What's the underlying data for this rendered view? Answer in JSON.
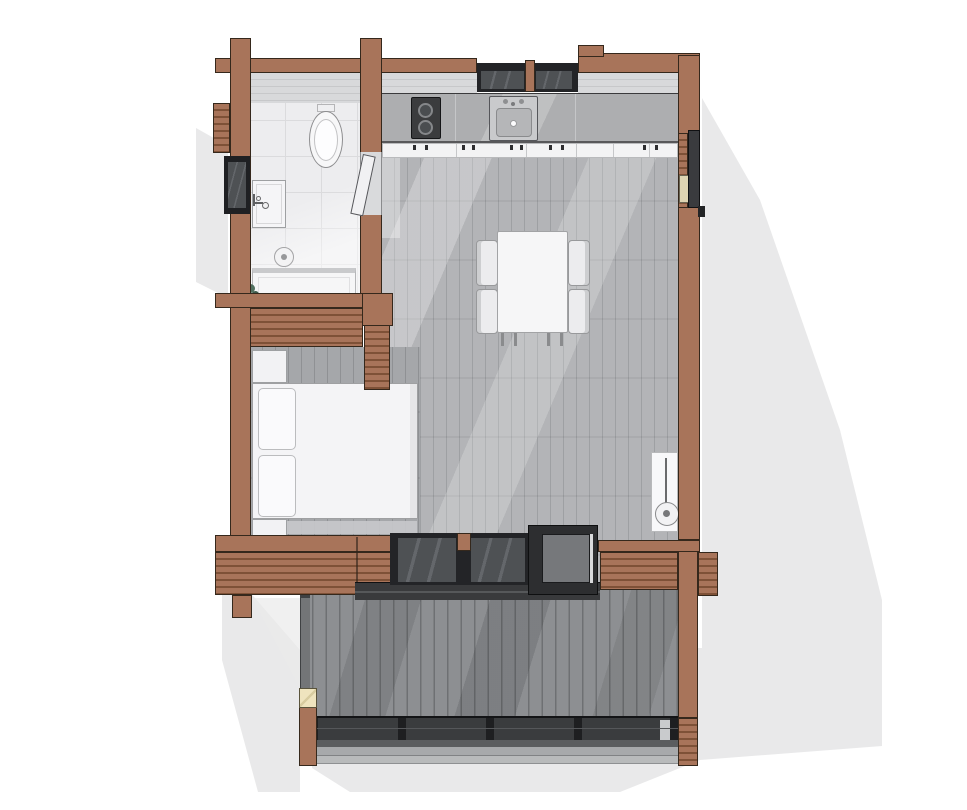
{
  "page": {
    "type": "floor-plan-rendering",
    "description": "Top-down 3D floor plan of a small log cabin: bathroom, kitchen with cooktop and sink, dining table with four chairs, sleeping alcove with double bed, floor lamp, entry doors and a large wooden deck with railing and steps"
  },
  "palette": {
    "bg": "#ffffff",
    "shadow": "#e9e9ea",
    "wall": "#a8745a",
    "wall_stripe": "#7e5137",
    "wall_outline": "#35281c",
    "wallface": "#d8d9db",
    "wallface_line": "#c7c8ca",
    "frame": "#232427",
    "glazing": "#4e5154",
    "glazing_hi": "#646growth"
  },
  "palette_fix": "see palette2",
  "palette2": {
    "glazing_hi": "#64676b",
    "floor_living": "#b3b4b7",
    "floor_living_gap": "#9ea0a3",
    "floor_bedroom": "#a5a7aa",
    "floor_bedroom_gap": "#8f9194",
    "floor_bath": "#ededef",
    "tile_line": "#dbdbdd",
    "counter": "#adaeb0",
    "cabinet": "#f3f3f4",
    "white_fixture": "#f5f5f7",
    "fixture_line": "#9ea0a2",
    "deck": "#8d8f92",
    "deck_gap": "#6e7073",
    "railing": "#3a3c3e",
    "railing_dark": "#1e1f21",
    "step_mid": "#a7a9ab",
    "step_light": "#b8babb",
    "platform": "#2d2e30",
    "platform_inner": "#76787b",
    "cream": "#efe4be",
    "plant": "#51705f",
    "threshold_dark": "#393a3c",
    "cooktop": "#3b3c3e",
    "sink_gray": "#c9cacc"
  },
  "rooms": [
    {
      "name": "bathroom",
      "fixtures": [
        "toilet",
        "wash-basin",
        "shower-drain",
        "shower-bench",
        "plant"
      ]
    },
    {
      "name": "kitchen",
      "fixtures": [
        "two-burner-cooktop",
        "kitchen-sink",
        "counter",
        "base-cabinets"
      ]
    },
    {
      "name": "living-dining",
      "fixtures": [
        "dining-table",
        "dining-chair",
        "dining-chair",
        "dining-chair",
        "dining-chair",
        "floor-lamp"
      ]
    },
    {
      "name": "sleeping-alcove",
      "fixtures": [
        "double-bed",
        "pillow",
        "pillow",
        "nightstand",
        "nightstand"
      ]
    },
    {
      "name": "deck",
      "fixtures": [
        "railing",
        "steps",
        "corner-post",
        "entry-platform"
      ]
    }
  ],
  "openings": [
    "north-window-pair",
    "west-window",
    "south-window-pair",
    "east-entry-door",
    "bathroom-door"
  ]
}
